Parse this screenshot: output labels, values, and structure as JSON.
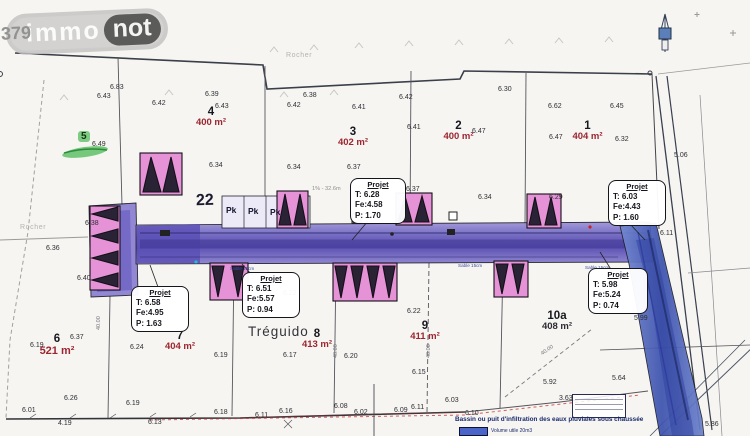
{
  "logo": {
    "prefix": "379",
    "part1": "immo",
    "part2": "not"
  },
  "labels": {
    "treguido": "Tréguido",
    "rocher_top": "Rocher",
    "rocher_left": "Rocher",
    "parking_count": "22",
    "pk": "Pk",
    "grade_note": "1% - 32.6m",
    "sable": "Sable 15cm",
    "lot5_badge": "5",
    "legend_title": "Bassin ou puit d'infiltration des eaux pluviales sous chaussée",
    "legend_volume": "Volume utile 20m3"
  },
  "lots": [
    {
      "number": "4",
      "area": "400 m²"
    },
    {
      "number": "3",
      "area": "402 m²"
    },
    {
      "number": "2",
      "area": "400 m²"
    },
    {
      "number": "1",
      "area": "404 m²"
    },
    {
      "number": "6",
      "area": "521 m²"
    },
    {
      "number": "7",
      "area": "404 m²"
    },
    {
      "number": "8",
      "area": "413 m²"
    },
    {
      "number": "9",
      "area": "411 m²"
    },
    {
      "number": "10a",
      "area": "408 m²"
    }
  ],
  "projets": [
    {
      "title": "Projet",
      "t": "T: 6.28",
      "fe": "Fe:4.58",
      "p": "P: 1.70"
    },
    {
      "title": "Projet",
      "t": "T: 6.03",
      "fe": "Fe:4.43",
      "p": "P: 1.60"
    },
    {
      "title": "Projet",
      "t": "T: 6.58",
      "fe": "Fe:4.95",
      "p": "P: 1.63"
    },
    {
      "title": "Projet",
      "t": "T: 6.51",
      "fe": "Fe:5.57",
      "p": "P: 0.94"
    },
    {
      "title": "Projet",
      "t": "T: 5.98",
      "fe": "Fe:5.24",
      "p": "P: 0.74"
    }
  ],
  "dims": [
    "40.00",
    "40.00",
    "40.00",
    "40.00"
  ],
  "colors": {
    "road_purple": "#5b50b4",
    "road_blue": "#4a5fbe",
    "strip_pink": "#e593d6",
    "area_red": "#9c2530",
    "legend_blue": "#4a64c8",
    "highlight_green": "#3eb54a"
  },
  "elevations": [
    {
      "v": "6.83",
      "x": 110,
      "y": 84
    },
    {
      "v": "6.43",
      "x": 97,
      "y": 93
    },
    {
      "v": "6.42",
      "x": 152,
      "y": 100
    },
    {
      "v": "6.39",
      "x": 205,
      "y": 91
    },
    {
      "v": "6.43",
      "x": 215,
      "y": 103
    },
    {
      "v": "6.38",
      "x": 303,
      "y": 92
    },
    {
      "v": "6.42",
      "x": 287,
      "y": 102
    },
    {
      "v": "6.41",
      "x": 352,
      "y": 104
    },
    {
      "v": "6.42",
      "x": 399,
      "y": 94
    },
    {
      "v": "6.30",
      "x": 498,
      "y": 86
    },
    {
      "v": "6.41",
      "x": 407,
      "y": 124
    },
    {
      "v": "6.47",
      "x": 472,
      "y": 128
    },
    {
      "v": "6.62",
      "x": 548,
      "y": 103
    },
    {
      "v": "6.45",
      "x": 610,
      "y": 103
    },
    {
      "v": "6.47",
      "x": 549,
      "y": 134
    },
    {
      "v": "6.32",
      "x": 615,
      "y": 136
    },
    {
      "v": "6.34",
      "x": 209,
      "y": 162
    },
    {
      "v": "6.34",
      "x": 287,
      "y": 164
    },
    {
      "v": "6.37",
      "x": 347,
      "y": 164
    },
    {
      "v": "6.49",
      "x": 92,
      "y": 141
    },
    {
      "v": "6.37",
      "x": 406,
      "y": 186
    },
    {
      "v": "6.34",
      "x": 478,
      "y": 194
    },
    {
      "v": "6.29",
      "x": 549,
      "y": 194
    },
    {
      "v": "6.36",
      "x": 46,
      "y": 245
    },
    {
      "v": "6.38",
      "x": 85,
      "y": 220
    },
    {
      "v": "6.40",
      "x": 77,
      "y": 275
    },
    {
      "v": "6.19",
      "x": 30,
      "y": 342
    },
    {
      "v": "6.37",
      "x": 70,
      "y": 334
    },
    {
      "v": "6.26",
      "x": 64,
      "y": 395
    },
    {
      "v": "6.24",
      "x": 130,
      "y": 344
    },
    {
      "v": "6.19",
      "x": 214,
      "y": 352
    },
    {
      "v": "6.17",
      "x": 283,
      "y": 352
    },
    {
      "v": "6.20",
      "x": 344,
      "y": 353
    },
    {
      "v": "6.22",
      "x": 283,
      "y": 290
    },
    {
      "v": "6.22",
      "x": 407,
      "y": 308
    },
    {
      "v": "6.15",
      "x": 412,
      "y": 369
    },
    {
      "v": "5.99",
      "x": 634,
      "y": 315
    },
    {
      "v": "5.92",
      "x": 543,
      "y": 379
    },
    {
      "v": "5.64",
      "x": 612,
      "y": 375
    },
    {
      "v": "6.01",
      "x": 22,
      "y": 407
    },
    {
      "v": "6.19",
      "x": 126,
      "y": 400
    },
    {
      "v": "6.18",
      "x": 214,
      "y": 409
    },
    {
      "v": "4.19",
      "x": 58,
      "y": 420
    },
    {
      "v": "6.13",
      "x": 148,
      "y": 419
    },
    {
      "v": "6.11",
      "x": 255,
      "y": 412
    },
    {
      "v": "6.16",
      "x": 279,
      "y": 408
    },
    {
      "v": "6.08",
      "x": 334,
      "y": 403
    },
    {
      "v": "6.02",
      "x": 354,
      "y": 409
    },
    {
      "v": "6.09",
      "x": 394,
      "y": 407
    },
    {
      "v": "6.11",
      "x": 411,
      "y": 404
    },
    {
      "v": "6.11",
      "x": 660,
      "y": 230
    },
    {
      "v": "5.06",
      "x": 674,
      "y": 152
    },
    {
      "v": "3.63",
      "x": 559,
      "y": 395
    },
    {
      "v": "6.03",
      "x": 445,
      "y": 397
    },
    {
      "v": "6.10",
      "x": 465,
      "y": 410
    },
    {
      "v": "5.86",
      "x": 705,
      "y": 421
    }
  ]
}
